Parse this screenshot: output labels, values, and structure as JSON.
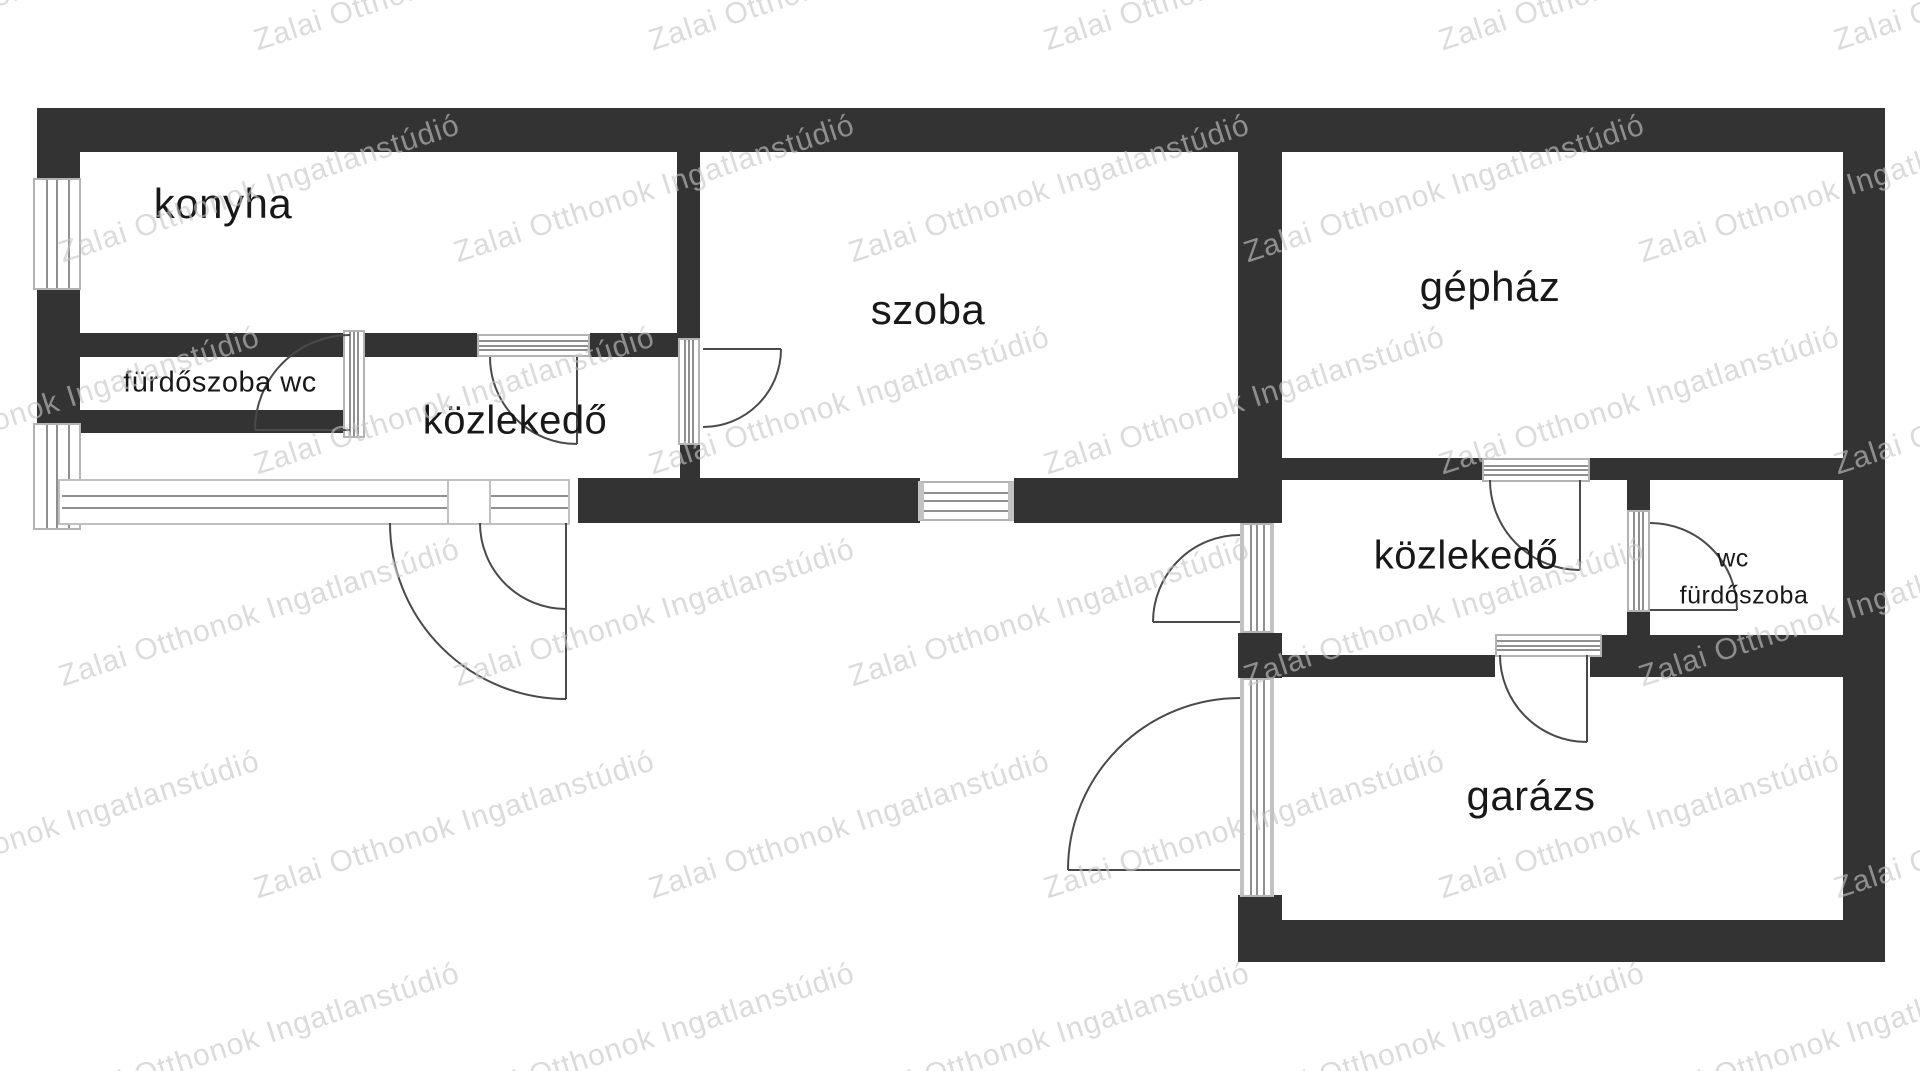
{
  "watermark": {
    "text": "Zalai Otthonok Ingatlanstúdió",
    "color": "#c6c6c6",
    "angle_deg": -18
  },
  "colors": {
    "wall": "#333333",
    "background": "#ffffff",
    "frame_border": "#b3b3b3",
    "frame_line": "#8f8f8f",
    "door_arc": "#4a4a4a",
    "label": "#181818"
  },
  "rooms": {
    "konyha": {
      "label": "konyha"
    },
    "furdoszoba_wc": {
      "label": "fürdőszoba wc"
    },
    "kozlekedo_1": {
      "label": "közlekedő"
    },
    "szoba": {
      "label": "szoba"
    },
    "gephaz": {
      "label": "gépház"
    },
    "kozlekedo_2": {
      "label": "közlekedő"
    },
    "wc": {
      "label": "wc"
    },
    "furdoszoba_right": {
      "label": "fürdőszoba"
    },
    "garazs": {
      "label": "garázs"
    }
  }
}
